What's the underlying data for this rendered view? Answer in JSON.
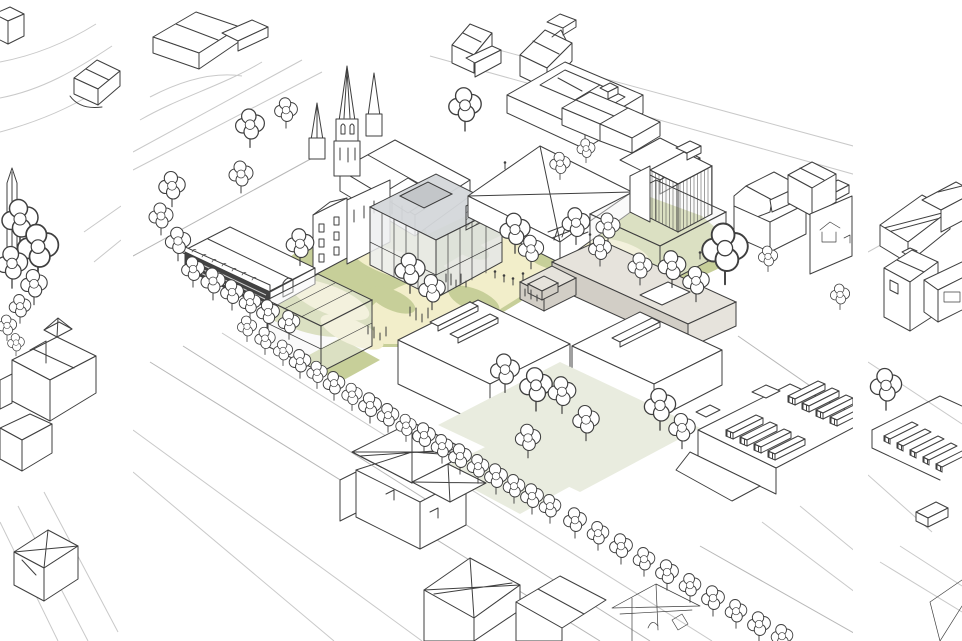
{
  "artwork": {
    "kind": "architectural axonometric line drawing",
    "panels": [
      {
        "name": "left-context-drawing"
      },
      {
        "name": "main-axonometric-masterplan"
      },
      {
        "name": "right-context-drawing"
      }
    ],
    "elements": [
      "church with tall spire",
      "market hall with dark arcade facade",
      "translucent glass cube building",
      "large hipped-roof hall",
      "transparent wireframe volume",
      "striped tower",
      "mansard-roof buildings",
      "long grey slab building",
      "courtyard blocks with rooflights",
      "sawtooth-louvre roof building",
      "tree-lined avenue",
      "park lawns with paths",
      "plaza with planting islands and people",
      "cross-braced roof church",
      "gabled houses",
      "street tree rows"
    ]
  },
  "palette": {
    "background": "#ffffff",
    "line": "#3f3f3f",
    "faint_line": "#c9c9c9",
    "road_line": "#b7b7b7",
    "building_white": "#ffffff",
    "lawn_green": "#c7cf99",
    "path_cream": "#f2eeca",
    "courtyard_pale": "#e9ecdf",
    "glass_top": "#d4d7da",
    "glass_side": "#edeef0",
    "glass_side2": "#e3e6e8",
    "glass_wire": "#f3f4f5",
    "slab_grey": "#d2cec6",
    "slab_top": "#e6e3dc",
    "hatch_grey": "#aab0b5",
    "dark_facade": "#424242",
    "tree_fill": "#ffffff"
  }
}
